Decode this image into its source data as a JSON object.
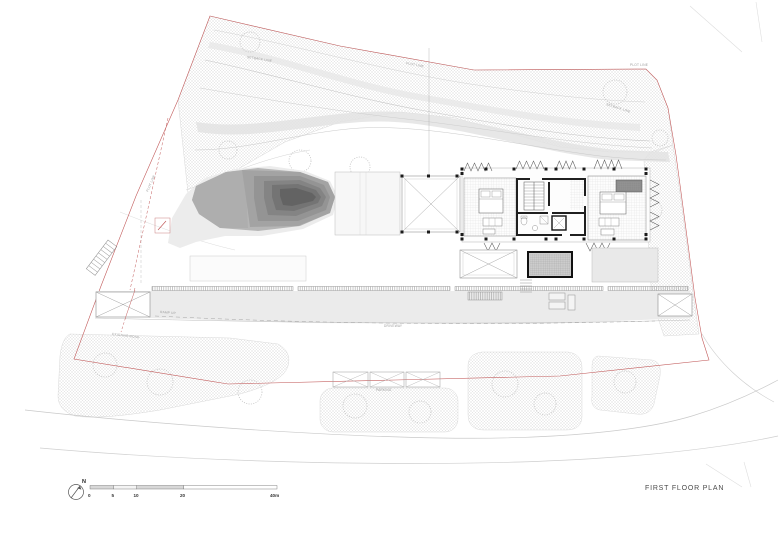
{
  "drawing": {
    "title": "FIRST FLOOR PLAN",
    "north_label": "N",
    "scale_bar": {
      "labels": [
        "0",
        "5",
        "10",
        "20",
        "40m"
      ]
    },
    "annotations": {
      "setback_top": "SETBACK LINE",
      "plot_top": "PLOT LINE",
      "plot_right": "PLOT LINE",
      "setback_right": "SETBACK LINE",
      "plot_left": "PLOT LINE",
      "ramp": "RAMP UP",
      "road": "EXISTING ROAD",
      "driveway": "DRIVEWAY",
      "parking": "PARKING"
    },
    "colors": {
      "boundary_red": "#c25b5b",
      "ink": "#3a3a3a",
      "hatch_grey": "#d9d9d9",
      "pond_light": "#b3b3b3",
      "pond_dark": "#5c5c5c",
      "paving_grey": "#ebebeb"
    }
  }
}
